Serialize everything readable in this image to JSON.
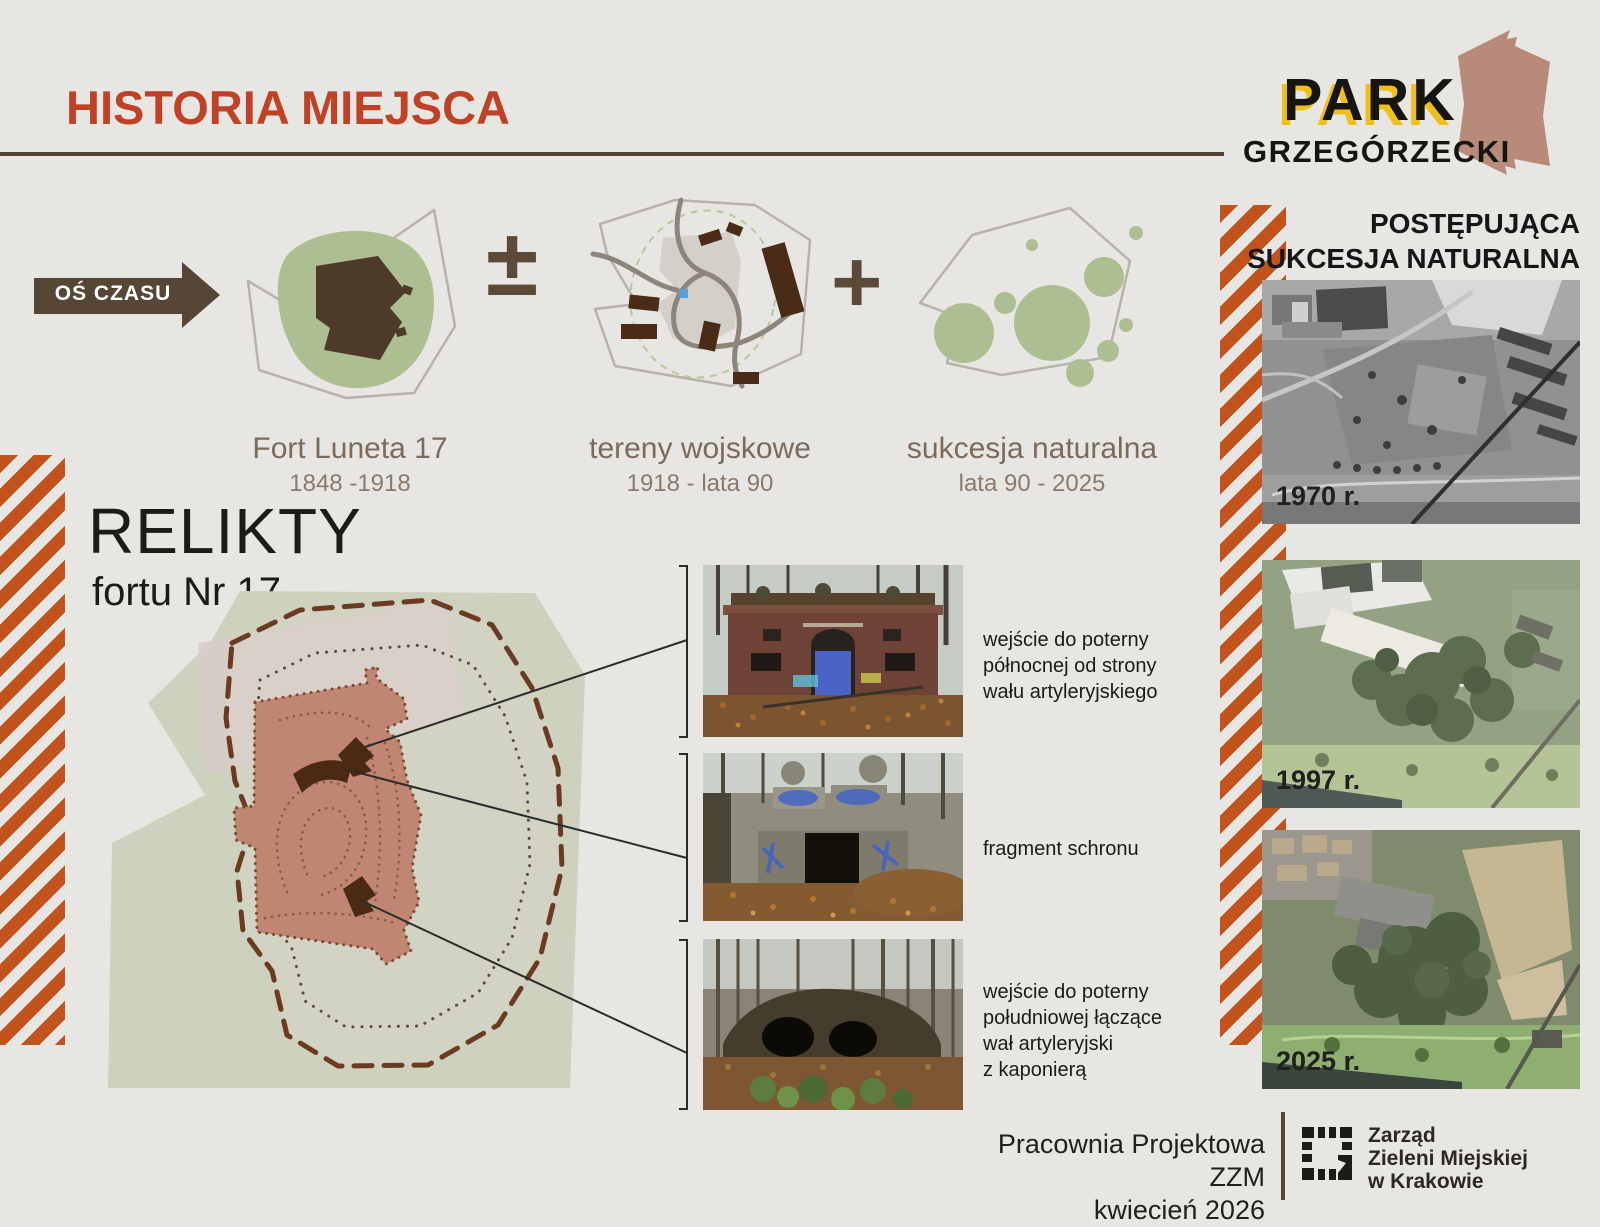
{
  "header": {
    "title": "HISTORIA MIEJSCA"
  },
  "logo": {
    "word": "PARK",
    "subtitle": "GRZEGÓRZECKI"
  },
  "timeline": {
    "axis_label": "OŚ CZASU",
    "operator_plusminus": "±",
    "operator_plus": "+",
    "stages": [
      {
        "name": "Fort Luneta 17",
        "years": "1848 -1918"
      },
      {
        "name": "tereny wojskowe",
        "years": "1918 - lata 90"
      },
      {
        "name": "sukcesja naturalna",
        "years": "lata 90 - 2025"
      }
    ]
  },
  "relikty": {
    "title": "RELIKTY",
    "subtitle": "fortu Nr 17"
  },
  "relics": [
    {
      "caption_lines": [
        "wejście do poterny",
        "północnej od strony",
        "wału artyleryjskiego"
      ]
    },
    {
      "caption_lines": [
        "fragment schronu"
      ]
    },
    {
      "caption_lines": [
        "wejście do poterny",
        "południowej łączące",
        "wał artyleryjski",
        "z kaponierą"
      ]
    }
  ],
  "succession": {
    "header_lines": [
      "POSTĘPUJĄCA",
      "SUKCESJA NATURALNA"
    ],
    "photos": [
      {
        "year_label": "1970 r."
      },
      {
        "year_label": "1997 r."
      },
      {
        "year_label": "2025 r."
      }
    ]
  },
  "footer": {
    "studio": "Pracownia Projektowa ZZM",
    "date": "kwiecień 2026",
    "org_lines": [
      "Zarząd",
      "Zieleni Miejskiej",
      "w Krakowie"
    ]
  },
  "colors": {
    "background": "#e8e6e3",
    "accent_red": "#bf4226",
    "dark_brown": "#4e4336",
    "stripe_orange": "#c3531c",
    "sage_green": "#aebe93",
    "map_sage": "#cdd1bd",
    "fort_salmon": "#c08573",
    "dashed_brown": "#6b3a21",
    "logo_yellow": "#f0c01a",
    "logo_rose": "#b78a79"
  }
}
